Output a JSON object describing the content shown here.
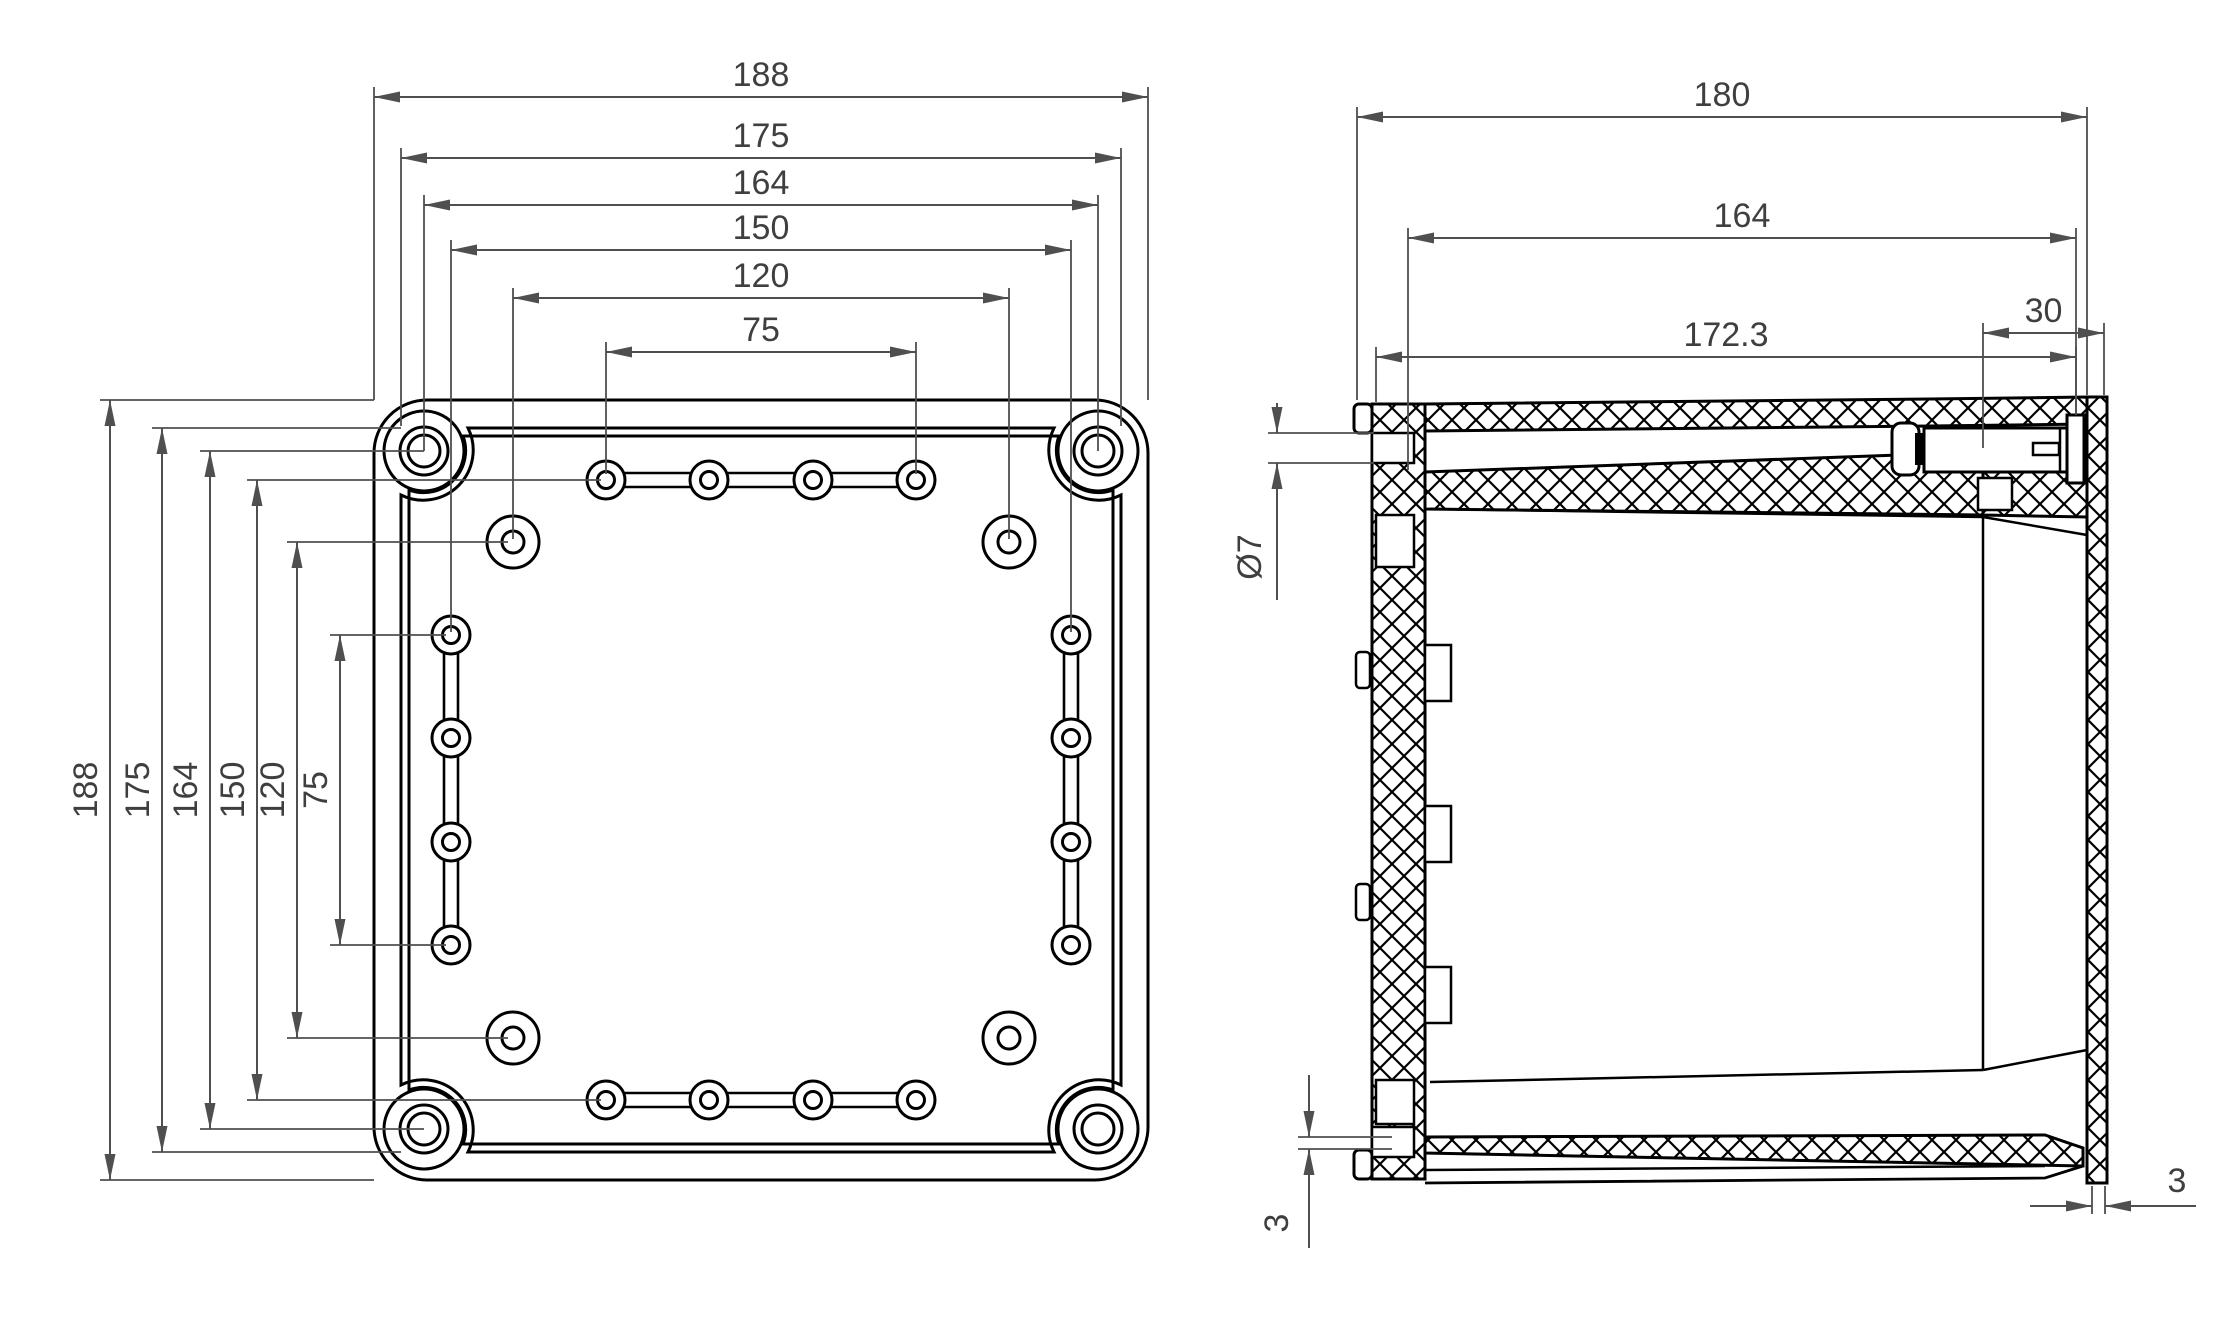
{
  "drawing_type": "enclosure-dimension-drawing",
  "style": {
    "background": "#ffffff",
    "outline_color": "#000000",
    "dimension_color": "#4f4f4f",
    "text_color": "#3f3f3f"
  },
  "front_view": {
    "dims_top": [
      "188",
      "175",
      "164",
      "150",
      "120",
      "75"
    ],
    "dims_left": [
      "188",
      "175",
      "164",
      "150",
      "120",
      "75"
    ],
    "outer_size_mm": 188,
    "rim_size_mm": 175,
    "corner_boss_spacing_mm": 164,
    "side_hole_column_spacing_mm": 150,
    "inset_hole_spacing_mm": 120,
    "hole_row_span_mm": 75,
    "hole_step_mm": 25
  },
  "side_view": {
    "dims_top": [
      "180",
      "164",
      "172.3"
    ],
    "dim_cover_depth": "30",
    "dim_hole_diameter": "Ø7",
    "dim_wall_left": "3",
    "dim_wall_right": "3",
    "overall_depth_mm": 180,
    "body_depth_mm": 164,
    "inner_depth_mm": 172.3,
    "cover_depth_mm": 30,
    "flange_hole_diameter_mm": 7,
    "wall_thickness_mm": 3
  }
}
